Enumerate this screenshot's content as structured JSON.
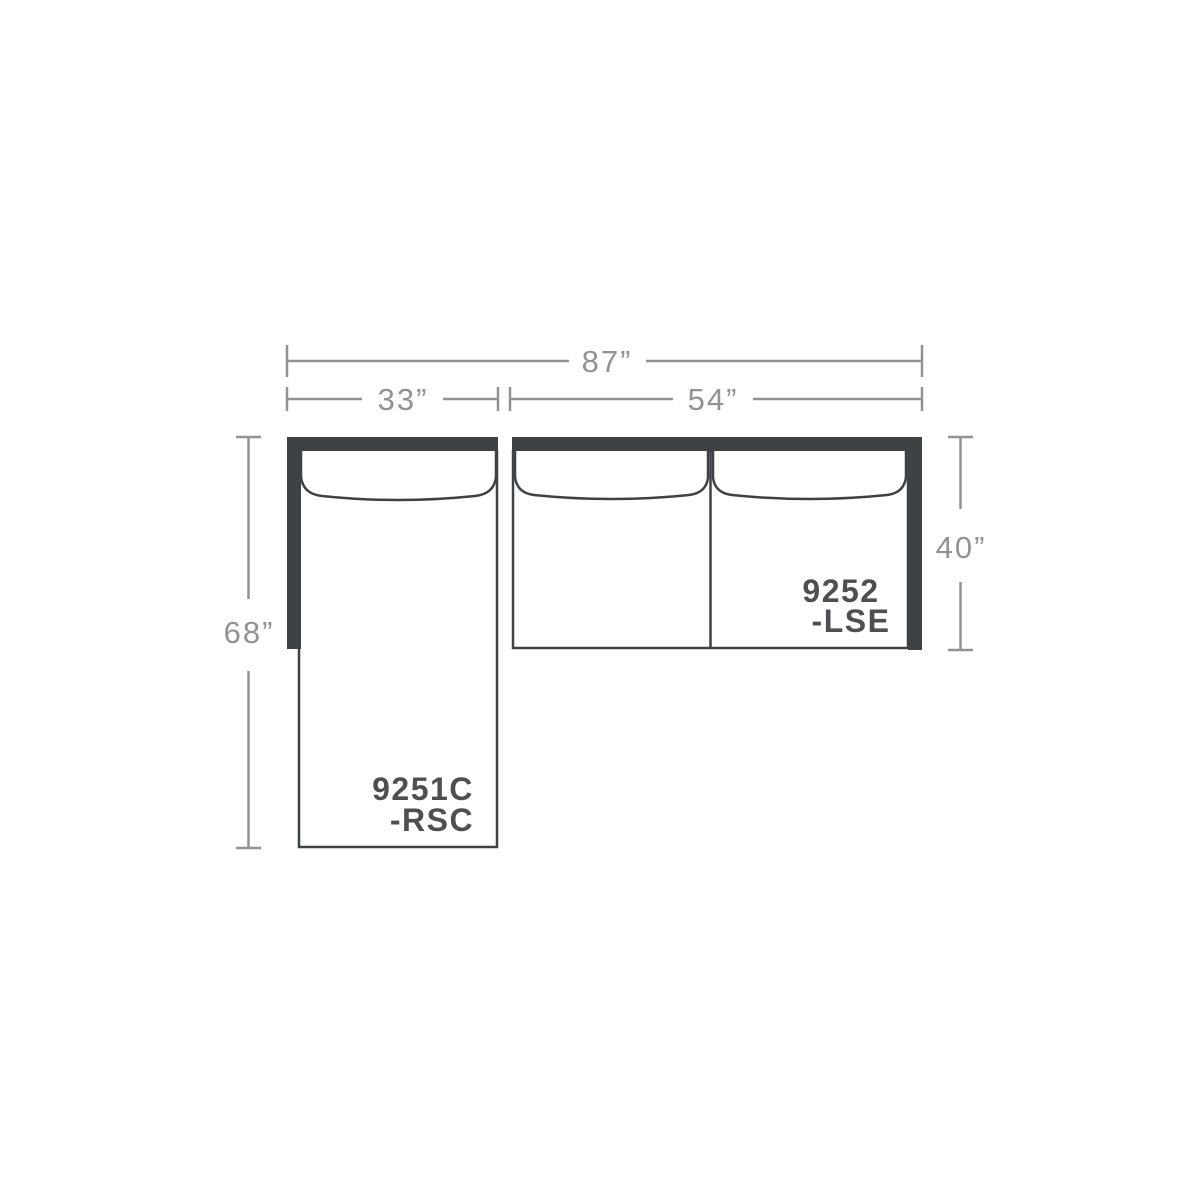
{
  "diagram": {
    "type": "sectional-sofa-floorplan",
    "colors": {
      "frame": "#3f4245",
      "dimension_lines": "#909395",
      "piece_labels": "#4d5053",
      "background": "#ffffff"
    },
    "dimensions": {
      "overall_width": "87”",
      "chaise_width": "33”",
      "sofa_width": "54”",
      "chaise_depth": "68”",
      "sofa_depth": "40”"
    },
    "pieces": [
      {
        "model": "9251C",
        "position_code": "-RSC"
      },
      {
        "model": "9252",
        "position_code": "-LSE"
      }
    ]
  }
}
